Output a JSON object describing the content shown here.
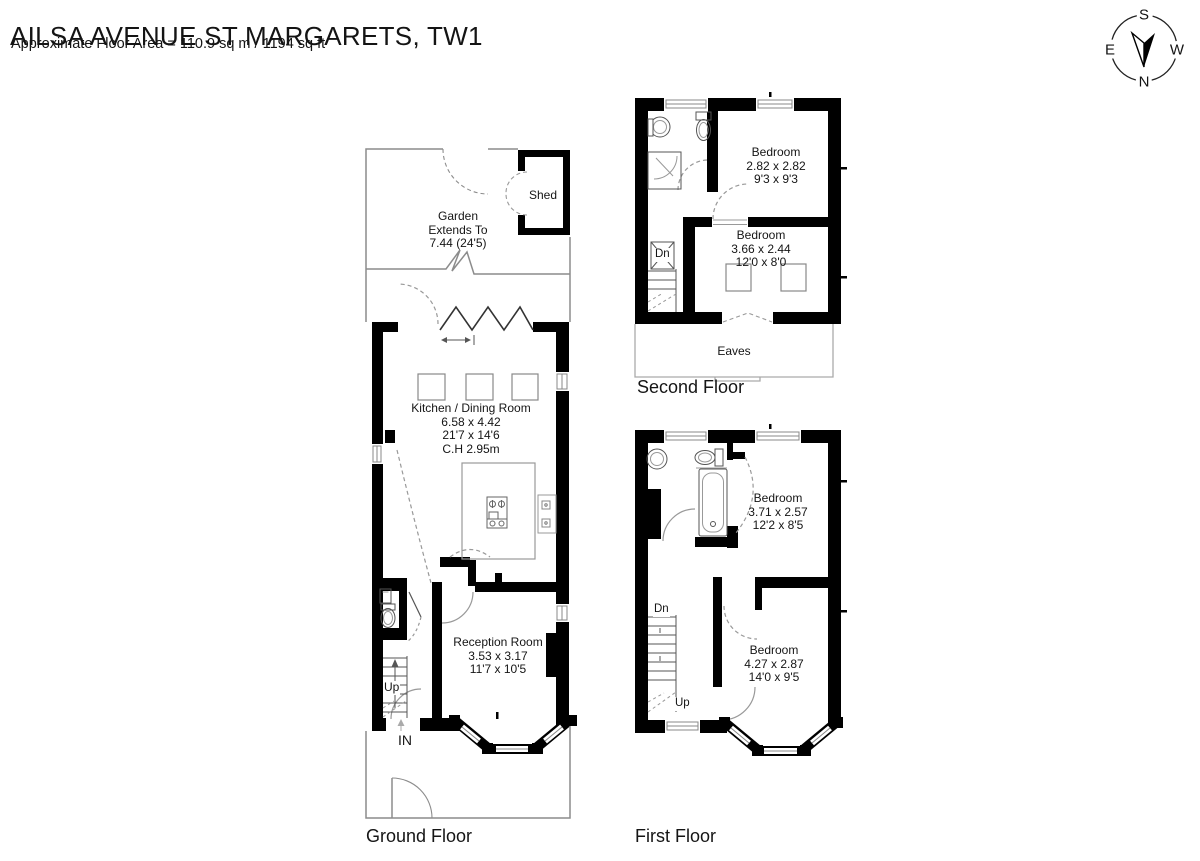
{
  "header": {
    "title": "AILSA AVENUE ST MARGARETS, TW1",
    "subtitle": "Approximate Floor Area = 110.9 sq m / 1194 sq ft"
  },
  "compass": {
    "north": "N",
    "south": "S",
    "east": "E",
    "west": "W"
  },
  "ground_floor": {
    "label": "Ground Floor",
    "garden": {
      "lines": [
        "Garden",
        "Extends To",
        "7.44 (24'5)"
      ]
    },
    "shed_label": "Shed",
    "kitchen": {
      "lines": [
        "Kitchen / Dining Room",
        "6.58 x 4.42",
        "21'7 x 14'6",
        "C.H 2.95m"
      ]
    },
    "reception": {
      "lines": [
        "Reception Room",
        "3.53 x 3.17",
        "11'7 x 10'5"
      ]
    },
    "stairs_up_label": "Up",
    "entrance_label": "IN"
  },
  "first_floor": {
    "label": "First Floor",
    "bedroom_rear": {
      "lines": [
        "Bedroom",
        "3.71 x 2.57",
        "12'2 x 8'5"
      ]
    },
    "bedroom_front": {
      "lines": [
        "Bedroom",
        "4.27 x 2.87",
        "14'0 x 9'5"
      ]
    },
    "stairs_dn_label": "Dn",
    "stairs_up_label": "Up"
  },
  "second_floor": {
    "label": "Second Floor",
    "bedroom_rear": {
      "lines": [
        "Bedroom",
        "2.82 x 2.82",
        "9'3 x 9'3"
      ]
    },
    "bedroom_front": {
      "lines": [
        "Bedroom",
        "3.66 x 2.44",
        "12'0 x 8'0"
      ]
    },
    "stairs_dn_label": "Dn",
    "eaves_label": "Eaves"
  },
  "colors": {
    "wall": "#000000",
    "light_line": "#8c8c8c",
    "text": "#141414"
  }
}
